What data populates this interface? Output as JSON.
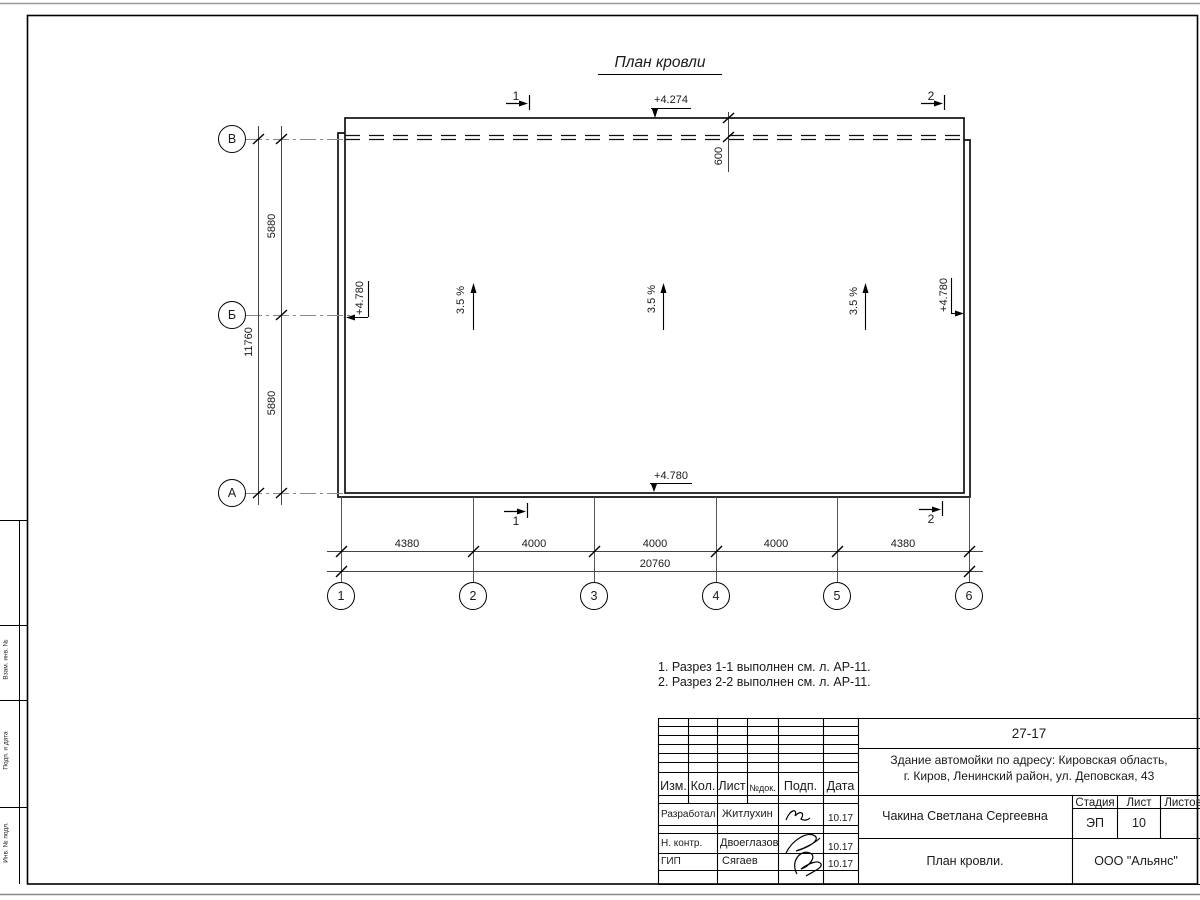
{
  "drawing": {
    "title": "План кровли",
    "elevations": {
      "top": "+4.274",
      "left": "+4.780",
      "right": "+4.780",
      "bottom": "+4.780"
    },
    "slopes": [
      "3.5 %",
      "3.5 %",
      "3.5 %"
    ],
    "dim_600": "600",
    "row_axes": [
      "В",
      "Б",
      "А"
    ],
    "col_axes": [
      "1",
      "2",
      "3",
      "4",
      "5",
      "6"
    ],
    "left_dims": [
      "5880",
      "5880"
    ],
    "left_total": "11760",
    "bottom_dims": [
      "4380",
      "4000",
      "4000",
      "4000",
      "4380"
    ],
    "bottom_total": "20760",
    "sections": {
      "top1": "1",
      "top2": "2",
      "bottom1": "1",
      "bottom2": "2"
    }
  },
  "notes": [
    "1. Разрез 1-1 выполнен см. л. АР-11.",
    "2. Разрез 2-2 выполнен см. л. АР-11."
  ],
  "margin": {
    "labels": [
      "Взам. инв. №",
      "Подп. и дата",
      "Инв. № подл."
    ]
  },
  "title_block": {
    "doc_code": "27-17",
    "address_line1": "Здание автомойки по адресу: Кировская область,",
    "address_line2": "г. Киров, Ленинский район, ул. Деповская, 43",
    "header": {
      "izm": "Изм.",
      "kol": "Кол.",
      "list": "Лист",
      "doc": "№док.",
      "podp": "Подп.",
      "data": "Дата"
    },
    "rows": [
      {
        "role": "Разработал",
        "name": "Житлухин",
        "date": "10.17"
      },
      {
        "role": "Н. контр.",
        "name": "Двоеглазов",
        "date": "10.17"
      },
      {
        "role": "ГИП",
        "name": "Сягаев",
        "date": "10.17"
      }
    ],
    "author": "Чакина Светлана Сергеевна",
    "stage_label": "Стадия",
    "sheet_label": "Лист",
    "sheets_label": "Листов",
    "stage": "ЭП",
    "sheet": "10",
    "sheet_title": "План кровли.",
    "company": "ООО \"Альянс\""
  }
}
